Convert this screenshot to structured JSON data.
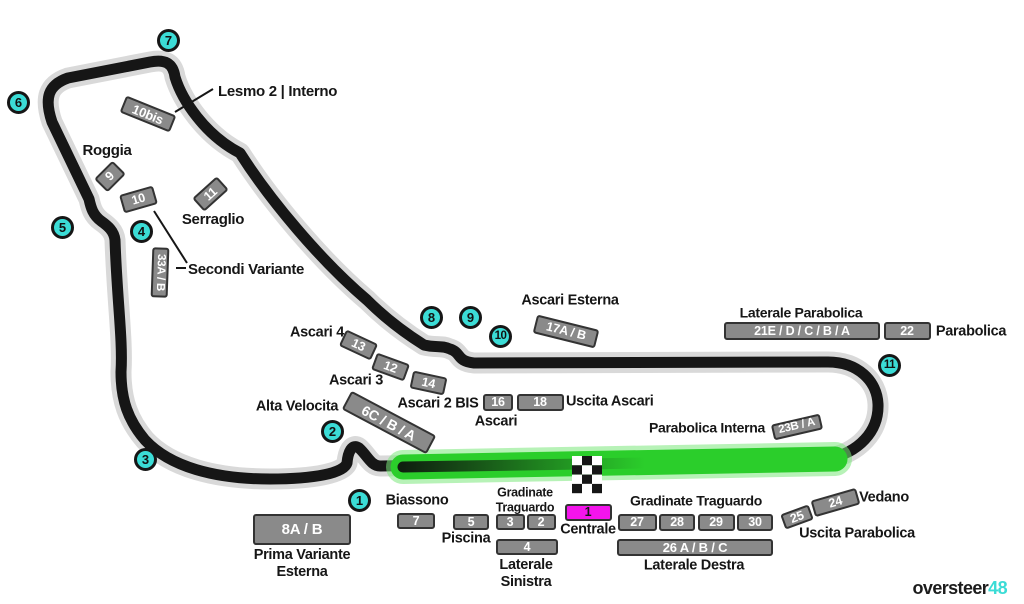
{
  "colors": {
    "cyan": "#3BDCD6",
    "magenta": "#F414EC",
    "track": "#161616",
    "halo": "#D9D9D9",
    "green": "#2BCE2B",
    "green_glow": "#7CE87C",
    "stand_gray": "#8A8A8A",
    "stand_border": "#333333",
    "background": "#FFFFFF"
  },
  "logo": {
    "black": "oversteer",
    "accent": "48"
  },
  "turns": [
    {
      "n": "1",
      "x": 360,
      "y": 501
    },
    {
      "n": "2",
      "x": 333,
      "y": 432
    },
    {
      "n": "3",
      "x": 146,
      "y": 460
    },
    {
      "n": "4",
      "x": 142,
      "y": 232
    },
    {
      "n": "5",
      "x": 63,
      "y": 228
    },
    {
      "n": "6",
      "x": 19,
      "y": 103
    },
    {
      "n": "7",
      "x": 169,
      "y": 41
    },
    {
      "n": "8",
      "x": 432,
      "y": 318
    },
    {
      "n": "9",
      "x": 471,
      "y": 318
    },
    {
      "n": "10",
      "x": 501,
      "y": 337
    },
    {
      "n": "11",
      "x": 890,
      "y": 366
    }
  ],
  "stands": [
    {
      "label": "10bis",
      "x": 148,
      "y": 114,
      "w": 54,
      "h": 18,
      "rot": 22,
      "fs": 13
    },
    {
      "label": "9",
      "x": 110,
      "y": 176,
      "w": 26,
      "h": 19,
      "rot": -45
    },
    {
      "label": "10",
      "x": 138,
      "y": 199,
      "w": 35,
      "h": 19,
      "rot": -16
    },
    {
      "label": "11",
      "x": 210,
      "y": 194,
      "w": 33,
      "h": 18,
      "rot": -42
    },
    {
      "label": "33A / B",
      "x": 160,
      "y": 272,
      "w": 50,
      "h": 17,
      "rot": 92,
      "fs": 11.5
    },
    {
      "label": "13",
      "x": 358,
      "y": 345,
      "w": 35,
      "h": 18,
      "rot": 25
    },
    {
      "label": "12",
      "x": 390,
      "y": 367,
      "w": 35,
      "h": 18,
      "rot": 20
    },
    {
      "label": "14",
      "x": 428,
      "y": 383,
      "w": 35,
      "h": 18,
      "rot": 12
    },
    {
      "label": "6C / B / A",
      "x": 389,
      "y": 422,
      "w": 96,
      "h": 21,
      "rot": 28,
      "fs": 14
    },
    {
      "label": "17A / B",
      "x": 566,
      "y": 331,
      "w": 64,
      "h": 19,
      "rot": 14,
      "fs": 12.5
    },
    {
      "label": "16",
      "x": 498,
      "y": 402,
      "w": 30,
      "h": 17
    },
    {
      "label": "18",
      "x": 540,
      "y": 402,
      "w": 47,
      "h": 17
    },
    {
      "label": "21E / D / C / B / A",
      "x": 802,
      "y": 331,
      "w": 156,
      "h": 18,
      "fs": 12.5
    },
    {
      "label": "22",
      "x": 907,
      "y": 331,
      "w": 47,
      "h": 18
    },
    {
      "label": "23B / A",
      "x": 797,
      "y": 427,
      "w": 50,
      "h": 16,
      "rot": -13,
      "fs": 11.5
    },
    {
      "label": "7",
      "x": 416,
      "y": 521,
      "w": 38,
      "h": 16
    },
    {
      "label": "8A / B",
      "x": 302,
      "y": 529,
      "w": 98,
      "h": 31,
      "fs": 15
    },
    {
      "label": "5",
      "x": 471,
      "y": 522,
      "w": 36,
      "h": 16
    },
    {
      "label": "3",
      "x": 510,
      "y": 522,
      "w": 29,
      "h": 16
    },
    {
      "label": "2",
      "x": 541,
      "y": 522,
      "w": 29,
      "h": 16
    },
    {
      "label": "4",
      "x": 527,
      "y": 547,
      "w": 62,
      "h": 16
    },
    {
      "label": "1",
      "x": 588,
      "y": 512,
      "w": 47,
      "h": 17,
      "variant": "magenta"
    },
    {
      "label": "27",
      "x": 637,
      "y": 522,
      "w": 39,
      "h": 17
    },
    {
      "label": "28",
      "x": 677,
      "y": 522,
      "w": 36,
      "h": 17
    },
    {
      "label": "29",
      "x": 716,
      "y": 522,
      "w": 37,
      "h": 17
    },
    {
      "label": "30",
      "x": 755,
      "y": 522,
      "w": 36,
      "h": 17
    },
    {
      "label": "26 A / B / C",
      "x": 695,
      "y": 547,
      "w": 156,
      "h": 17,
      "fs": 13
    },
    {
      "label": "25",
      "x": 797,
      "y": 517,
      "w": 30,
      "h": 16,
      "rot": -20
    },
    {
      "label": "24",
      "x": 835,
      "y": 502,
      "w": 47,
      "h": 17,
      "rot": -16
    }
  ],
  "labels": [
    {
      "id": "lesmo-2-interno",
      "text": "Lesmo 2 | Interno",
      "x": 218,
      "y": 92,
      "anchor": "left",
      "fs": 15
    },
    {
      "id": "roggia",
      "text": "Roggia",
      "x": 107,
      "y": 151,
      "fs": 15
    },
    {
      "id": "serraglio",
      "text": "Serraglio",
      "x": 213,
      "y": 220,
      "fs": 15
    },
    {
      "id": "secondi-variante",
      "text": "Secondi Variante",
      "x": 188,
      "y": 270,
      "anchor": "left",
      "fs": 15
    },
    {
      "id": "ascari-4",
      "text": "Ascari 4",
      "x": 317,
      "y": 333,
      "fs": 14.5
    },
    {
      "id": "ascari-3",
      "text": "Ascari 3",
      "x": 356,
      "y": 381,
      "fs": 14.5
    },
    {
      "id": "ascari-2-bis",
      "text": "Ascari 2 BIS",
      "x": 438,
      "y": 404,
      "fs": 14.5
    },
    {
      "id": "ascari",
      "text": "Ascari",
      "x": 496,
      "y": 422,
      "fs": 14.5
    },
    {
      "id": "ascari-esterna",
      "text": "Ascari Esterna",
      "x": 570,
      "y": 301,
      "fs": 14.5
    },
    {
      "id": "uscita-ascari",
      "text": "Uscita Ascari",
      "x": 566,
      "y": 402,
      "anchor": "left",
      "fs": 14.5
    },
    {
      "id": "alta-velocita",
      "text": "Alta Velocita",
      "x": 297,
      "y": 407,
      "fs": 14.5
    },
    {
      "id": "laterale-parabolica",
      "text": "Laterale Parabolica",
      "x": 801,
      "y": 313,
      "fs": 14
    },
    {
      "id": "parabolica",
      "text": "Parabolica",
      "x": 971,
      "y": 332,
      "fs": 14.5
    },
    {
      "id": "parabolica-interna",
      "text": "Parabolica Interna",
      "x": 707,
      "y": 428,
      "fs": 14
    },
    {
      "id": "biassono",
      "text": "Biassono",
      "x": 417,
      "y": 501,
      "fs": 14.5
    },
    {
      "id": "piscina",
      "text": "Piscina",
      "x": 466,
      "y": 539,
      "fs": 14.5
    },
    {
      "id": "gradinate-traguardo-sx",
      "text": "Gradinate\nTraguardo",
      "x": 525,
      "y": 500,
      "fs": 12.5
    },
    {
      "id": "centrale",
      "text": "Centrale",
      "x": 588,
      "y": 530,
      "fs": 14.5
    },
    {
      "id": "gradinate-traguardo-dx",
      "text": "Gradinate Traguardo",
      "x": 696,
      "y": 501,
      "fs": 14
    },
    {
      "id": "laterale-destra",
      "text": "Laterale Destra",
      "x": 694,
      "y": 566,
      "fs": 14.5
    },
    {
      "id": "vedano",
      "text": "Vedano",
      "x": 884,
      "y": 498,
      "fs": 14.5
    },
    {
      "id": "uscita-parabolica",
      "text": "Uscita Parabolica",
      "x": 857,
      "y": 534,
      "fs": 14.5
    },
    {
      "id": "prima-variante-esterna",
      "text": "Prima Variante\nEsterna",
      "x": 302,
      "y": 564,
      "fs": 14.5
    },
    {
      "id": "laterale-sinistra",
      "text": "Laterale\nSinistra",
      "x": 526,
      "y": 574,
      "fs": 14.5
    }
  ]
}
